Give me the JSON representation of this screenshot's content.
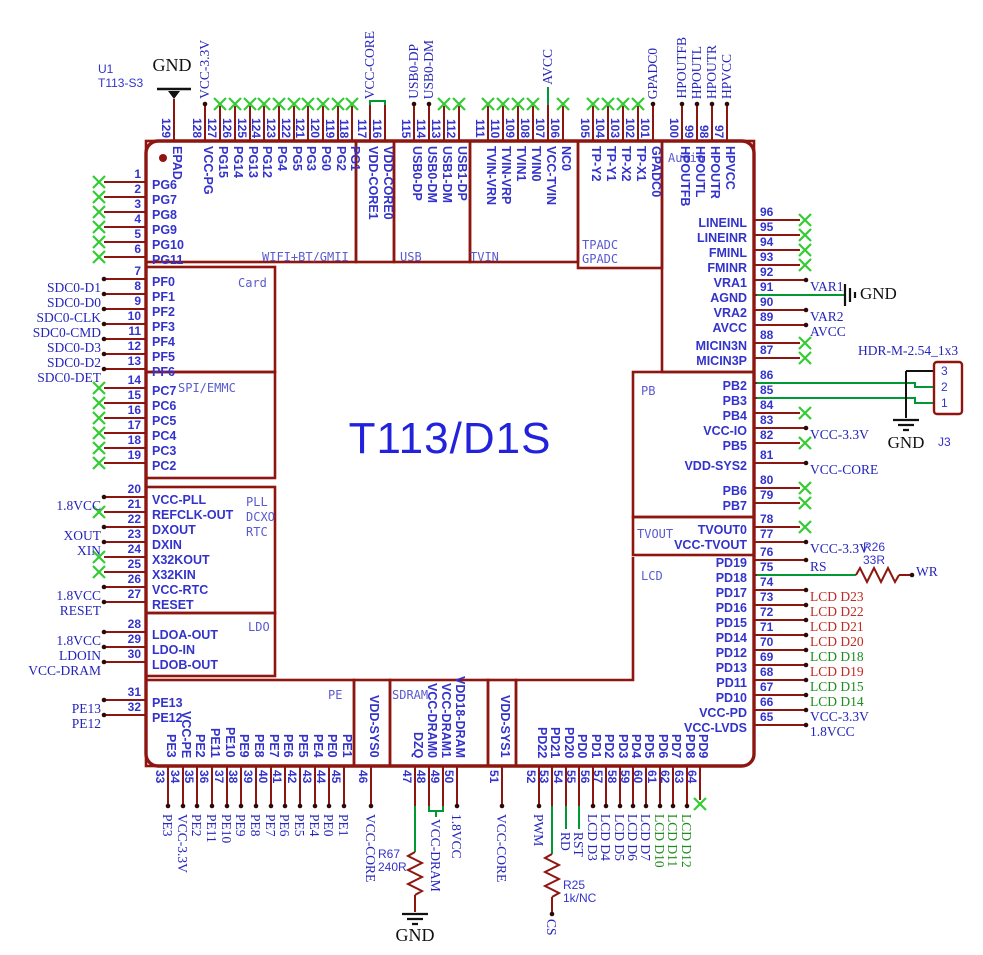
{
  "device": {
    "refdes": "U1",
    "part": "T113-S3",
    "title": "T113/D1S"
  },
  "labels": {
    "gnd": "GND"
  },
  "sections": [
    {
      "id": "wifi",
      "text": "WIFI+BT/GMII"
    },
    {
      "id": "usb",
      "text": "USB"
    },
    {
      "id": "tvin",
      "text": "TVIN"
    },
    {
      "id": "tpadc",
      "text": "TPADC"
    },
    {
      "id": "gpadc",
      "text": "GPADC"
    },
    {
      "id": "audio",
      "text": "Audio"
    },
    {
      "id": "card",
      "text": "Card"
    },
    {
      "id": "spi",
      "text": "SPI/EMMC"
    },
    {
      "id": "pll",
      "text": "PLL"
    },
    {
      "id": "dcxo",
      "text": "DCXO"
    },
    {
      "id": "rtc",
      "text": "RTC"
    },
    {
      "id": "ldo",
      "text": "LDO"
    },
    {
      "id": "pe",
      "text": "PE"
    },
    {
      "id": "sdram",
      "text": "SDRAM"
    },
    {
      "id": "pb",
      "text": "PB"
    },
    {
      "id": "tvout",
      "text": "TVOUT"
    },
    {
      "id": "lcd",
      "text": "LCD"
    }
  ],
  "components": {
    "r26": {
      "ref": "R26",
      "value": "33R",
      "net": "WR"
    },
    "r25": {
      "ref": "R25",
      "value": "1k/NC",
      "net": "CS"
    },
    "r67": {
      "ref": "R67",
      "value": "240R"
    },
    "j3": {
      "ref": "J3",
      "part": "HDR-M-2.54_1x3",
      "pins": [
        "3",
        "2",
        "1"
      ]
    }
  },
  "pins": {
    "top": [
      {
        "n": "129",
        "name": "EPAD",
        "mark": "long"
      },
      {
        "n": "128",
        "name": "VCC-PG",
        "mark": "dot",
        "net": {
          "t": "VCC-3.3V",
          "c": "blue"
        }
      },
      {
        "n": "127",
        "name": "PG15",
        "mark": "x"
      },
      {
        "n": "126",
        "name": "PG14",
        "mark": "x"
      },
      {
        "n": "125",
        "name": "PG13",
        "mark": "x"
      },
      {
        "n": "124",
        "name": "PG12",
        "mark": "x"
      },
      {
        "n": "123",
        "name": "PG4",
        "mark": "x"
      },
      {
        "n": "122",
        "name": "PG5",
        "mark": "x"
      },
      {
        "n": "121",
        "name": "PG3",
        "mark": "x"
      },
      {
        "n": "120",
        "name": "PG0",
        "mark": "x"
      },
      {
        "n": "119",
        "name": "PG2",
        "mark": "x"
      },
      {
        "n": "118",
        "name": "PG1",
        "mark": "x"
      },
      {
        "n": "117",
        "name": "VDD-CORE1",
        "mark": "none",
        "net": {
          "t": "VCC-CORE",
          "c": "blue"
        }
      },
      {
        "n": "116",
        "name": "VDD-CORE0",
        "mark": "none"
      },
      {
        "n": "115",
        "name": "USB0-DP",
        "mark": "dot",
        "net": {
          "t": "USB0-DP",
          "c": "blue"
        }
      },
      {
        "n": "114",
        "name": "USB0-DM",
        "mark": "dot",
        "net": {
          "t": "USB0-DM",
          "c": "blue"
        }
      },
      {
        "n": "113",
        "name": "USB1-DM",
        "mark": "x"
      },
      {
        "n": "112",
        "name": "USB1-DP",
        "mark": "x"
      },
      {
        "n": "111",
        "name": "TVIN-VRN",
        "mark": "x"
      },
      {
        "n": "110",
        "name": "TVIN-VRP",
        "mark": "x"
      },
      {
        "n": "109",
        "name": "TVIN1",
        "mark": "x"
      },
      {
        "n": "108",
        "name": "TVIN0",
        "mark": "x"
      },
      {
        "n": "107",
        "name": "VCC-TVIN",
        "mark": "none",
        "net": {
          "t": "AVCC",
          "c": "blue"
        },
        "lb": 870
      },
      {
        "n": "106",
        "name": "NC0",
        "mark": "x"
      },
      {
        "n": "105",
        "name": "TP-Y2",
        "mark": "x"
      },
      {
        "n": "104",
        "name": "TP-Y1",
        "mark": "x"
      },
      {
        "n": "103",
        "name": "TP-X2",
        "mark": "x"
      },
      {
        "n": "102",
        "name": "TP-X1",
        "mark": "x"
      },
      {
        "n": "101",
        "name": "GPADC0",
        "mark": "dot",
        "net": {
          "t": "GPADC0",
          "c": "blue"
        }
      },
      {
        "n": "100",
        "name": "HPOUTFB",
        "mark": "dot",
        "net": {
          "t": "HPOUTFB",
          "c": "blue"
        }
      },
      {
        "n": "99",
        "name": "HPOUTL",
        "mark": "dot",
        "net": {
          "t": "HPOUTL",
          "c": "blue"
        }
      },
      {
        "n": "98",
        "name": "HPOUTR",
        "mark": "dot",
        "net": {
          "t": "HPOUTR",
          "c": "blue"
        }
      },
      {
        "n": "97",
        "name": "HPVCC",
        "mark": "dot",
        "net": {
          "t": "HPVCC",
          "c": "blue"
        }
      }
    ],
    "left": [
      {
        "n": "1",
        "name": "PG6",
        "mark": "x"
      },
      {
        "n": "2",
        "name": "PG7",
        "mark": "x"
      },
      {
        "n": "3",
        "name": "PG8",
        "mark": "x"
      },
      {
        "n": "4",
        "name": "PG9",
        "mark": "x"
      },
      {
        "n": "5",
        "name": "PG10",
        "mark": "x"
      },
      {
        "n": "6",
        "name": "PG11",
        "mark": "x"
      },
      {
        "n": "7",
        "name": "PF0",
        "mark": "dot",
        "net": {
          "t": "SDC0-D1",
          "c": "blue"
        }
      },
      {
        "n": "8",
        "name": "PF1",
        "mark": "dot",
        "net": {
          "t": "SDC0-D0",
          "c": "blue"
        }
      },
      {
        "n": "9",
        "name": "PF2",
        "mark": "dot",
        "net": {
          "t": "SDC0-CLK",
          "c": "blue"
        }
      },
      {
        "n": "10",
        "name": "PF3",
        "mark": "dot",
        "net": {
          "t": "SDC0-CMD",
          "c": "blue"
        }
      },
      {
        "n": "11",
        "name": "PF4",
        "mark": "dot",
        "net": {
          "t": "SDC0-D3",
          "c": "blue"
        }
      },
      {
        "n": "12",
        "name": "PF5",
        "mark": "dot",
        "net": {
          "t": "SDC0-D2",
          "c": "blue"
        }
      },
      {
        "n": "13",
        "name": "PF6",
        "mark": "dot",
        "net": {
          "t": "SDC0-DET",
          "c": "blue"
        }
      },
      {
        "n": "14",
        "name": "PC7",
        "mark": "x"
      },
      {
        "n": "15",
        "name": "PC6",
        "mark": "x"
      },
      {
        "n": "16",
        "name": "PC5",
        "mark": "x"
      },
      {
        "n": "17",
        "name": "PC4",
        "mark": "x"
      },
      {
        "n": "18",
        "name": "PC3",
        "mark": "x"
      },
      {
        "n": "19",
        "name": "PC2",
        "mark": "x"
      },
      {
        "n": "20",
        "name": "VCC-PLL",
        "mark": "dot",
        "net": {
          "t": "1.8VCC",
          "c": "blue"
        }
      },
      {
        "n": "21",
        "name": "REFCLK-OUT",
        "mark": "x"
      },
      {
        "n": "22",
        "name": "DXOUT",
        "mark": "dot",
        "net": {
          "t": "XOUT",
          "c": "blue"
        }
      },
      {
        "n": "23",
        "name": "DXIN",
        "mark": "dot",
        "net": {
          "t": "XIN",
          "c": "blue"
        }
      },
      {
        "n": "24",
        "name": "X32KOUT",
        "mark": "x"
      },
      {
        "n": "25",
        "name": "X32KIN",
        "mark": "x"
      },
      {
        "n": "26",
        "name": "VCC-RTC",
        "mark": "dot",
        "net": {
          "t": "1.8VCC",
          "c": "blue"
        }
      },
      {
        "n": "27",
        "name": "RESET",
        "mark": "dot",
        "net": {
          "t": "RESET",
          "c": "blue"
        }
      },
      {
        "n": "28",
        "name": "LDOA-OUT",
        "mark": "dot",
        "net": {
          "t": "1.8VCC",
          "c": "blue"
        }
      },
      {
        "n": "29",
        "name": "LDO-IN",
        "mark": "dot",
        "net": {
          "t": "LDOIN",
          "c": "blue"
        }
      },
      {
        "n": "30",
        "name": "LDOB-OUT",
        "mark": "dot",
        "net": {
          "t": "VCC-DRAM",
          "c": "blue"
        }
      },
      {
        "n": "31",
        "name": "PE13",
        "mark": "dot",
        "net": {
          "t": "PE13",
          "c": "blue"
        }
      },
      {
        "n": "32",
        "name": "PE12",
        "mark": "dot",
        "net": {
          "t": "PE12",
          "c": "blue"
        }
      }
    ],
    "right": [
      {
        "n": "96",
        "name": "LINEINL",
        "mark": "x"
      },
      {
        "n": "95",
        "name": "LINEINR",
        "mark": "x"
      },
      {
        "n": "94",
        "name": "FMINL",
        "mark": "x"
      },
      {
        "n": "93",
        "name": "FMINR",
        "mark": "x"
      },
      {
        "n": "92",
        "name": "VRA1",
        "mark": "dot",
        "net": {
          "t": "VAR1",
          "c": "blue"
        }
      },
      {
        "n": "91",
        "name": "AGND",
        "mark": "none"
      },
      {
        "n": "90",
        "name": "VRA2",
        "mark": "dot",
        "net": {
          "t": "VAR2",
          "c": "blue"
        }
      },
      {
        "n": "89",
        "name": "AVCC",
        "mark": "dot",
        "net": {
          "t": "AVCC",
          "c": "blue"
        }
      },
      {
        "n": "88",
        "name": "MICIN3N",
        "mark": "x"
      },
      {
        "n": "87",
        "name": "MICIN3P",
        "mark": "x"
      },
      {
        "n": "86",
        "name": "PB2",
        "mark": "none"
      },
      {
        "n": "85",
        "name": "PB3",
        "mark": "none"
      },
      {
        "n": "84",
        "name": "PB4",
        "mark": "x"
      },
      {
        "n": "83",
        "name": "VCC-IO",
        "mark": "dot",
        "net": {
          "t": "VCC-3.3V",
          "c": "blue"
        }
      },
      {
        "n": "82",
        "name": "PB5",
        "mark": "x"
      },
      {
        "n": "81",
        "name": "VDD-SYS2",
        "mark": "dot",
        "net": {
          "t": "VCC-CORE",
          "c": "blue"
        }
      },
      {
        "n": "80",
        "name": "PB6",
        "mark": "x"
      },
      {
        "n": "79",
        "name": "PB7",
        "mark": "x"
      },
      {
        "n": "78",
        "name": "TVOUT0",
        "mark": "x"
      },
      {
        "n": "77",
        "name": "VCC-TVOUT",
        "mark": "dot",
        "net": {
          "t": "VCC-3.3V",
          "c": "blue"
        }
      },
      {
        "n": "76",
        "name": "PD19",
        "mark": "dot",
        "net": {
          "t": "RS",
          "c": "blue"
        }
      },
      {
        "n": "75",
        "name": "PD18",
        "mark": "none"
      },
      {
        "n": "74",
        "name": "PD17",
        "mark": "dot",
        "net": {
          "t": "LCD D23",
          "c": "red"
        }
      },
      {
        "n": "73",
        "name": "PD16",
        "mark": "dot",
        "net": {
          "t": "LCD D22",
          "c": "red"
        }
      },
      {
        "n": "72",
        "name": "PD15",
        "mark": "dot",
        "net": {
          "t": "LCD D21",
          "c": "red"
        }
      },
      {
        "n": "71",
        "name": "PD14",
        "mark": "dot",
        "net": {
          "t": "LCD D20",
          "c": "red"
        }
      },
      {
        "n": "70",
        "name": "PD12",
        "mark": "dot",
        "net": {
          "t": "LCD D18",
          "c": "green"
        }
      },
      {
        "n": "69",
        "name": "PD13",
        "mark": "dot",
        "net": {
          "t": "LCD D19",
          "c": "red"
        }
      },
      {
        "n": "68",
        "name": "PD11",
        "mark": "dot",
        "net": {
          "t": "LCD D15",
          "c": "green"
        }
      },
      {
        "n": "67",
        "name": "PD10",
        "mark": "dot",
        "net": {
          "t": "LCD D14",
          "c": "green"
        }
      },
      {
        "n": "66",
        "name": "VCC-PD",
        "mark": "dot",
        "net": {
          "t": "VCC-3.3V",
          "c": "blue"
        }
      },
      {
        "n": "65",
        "name": "VCC-LVDS",
        "mark": "dot",
        "net": {
          "t": "1.8VCC",
          "c": "blue"
        }
      }
    ],
    "bottom": [
      {
        "n": "33",
        "name": "PE3",
        "mark": "dot",
        "net": {
          "t": "PE3",
          "c": "blue"
        }
      },
      {
        "n": "34",
        "name": "VCC-PE",
        "mark": "dot",
        "net": {
          "t": "VCC-3.3V",
          "c": "blue"
        }
      },
      {
        "n": "35",
        "name": "PE2",
        "mark": "dot",
        "net": {
          "t": "PE2",
          "c": "blue"
        }
      },
      {
        "n": "36",
        "name": "PE11",
        "mark": "dot",
        "net": {
          "t": "PE11",
          "c": "blue"
        }
      },
      {
        "n": "37",
        "name": "PE10",
        "mark": "dot",
        "net": {
          "t": "PE10",
          "c": "blue"
        }
      },
      {
        "n": "38",
        "name": "PE9",
        "mark": "dot",
        "net": {
          "t": "PE9",
          "c": "blue"
        }
      },
      {
        "n": "39",
        "name": "PE8",
        "mark": "dot",
        "net": {
          "t": "PE8",
          "c": "blue"
        }
      },
      {
        "n": "40",
        "name": "PE7",
        "mark": "dot",
        "net": {
          "t": "PE7",
          "c": "blue"
        }
      },
      {
        "n": "41",
        "name": "PE6",
        "mark": "dot",
        "net": {
          "t": "PE6",
          "c": "blue"
        }
      },
      {
        "n": "42",
        "name": "PE5",
        "mark": "dot",
        "net": {
          "t": "PE5",
          "c": "blue"
        }
      },
      {
        "n": "43",
        "name": "PE4",
        "mark": "dot",
        "net": {
          "t": "PE4",
          "c": "blue"
        }
      },
      {
        "n": "44",
        "name": "PE0",
        "mark": "dot",
        "net": {
          "t": "PE0",
          "c": "blue"
        }
      },
      {
        "n": "45",
        "name": "PE1",
        "mark": "dot",
        "net": {
          "t": "PE1",
          "c": "blue"
        }
      },
      {
        "n": "46",
        "name": "VDD-SYS0",
        "mark": "dot",
        "net": {
          "t": "VCC-CORE",
          "c": "blue"
        }
      },
      {
        "n": "47",
        "name": "DZQ",
        "mark": "none"
      },
      {
        "n": "48",
        "name": "VCC-DRAM0",
        "mark": "none"
      },
      {
        "n": "49",
        "name": "VCC-DRAM1",
        "mark": "none"
      },
      {
        "n": "50",
        "name": "VDD18-DRAM",
        "mark": "dot",
        "net": {
          "t": "1.8VCC",
          "c": "blue"
        }
      },
      {
        "n": "51",
        "name": "VDD-SYS1",
        "mark": "dot",
        "net": {
          "t": "VCC-CORE",
          "c": "blue"
        }
      },
      {
        "n": "52",
        "name": "PD22",
        "mark": "dot",
        "net": {
          "t": "PWM",
          "c": "blue"
        }
      },
      {
        "n": "53",
        "name": "PD21",
        "mark": "none"
      },
      {
        "n": "54",
        "name": "PD20",
        "mark": "none",
        "net": {
          "t": "RD",
          "c": "blue"
        },
        "lt": 832
      },
      {
        "n": "55",
        "name": "PD0",
        "mark": "none",
        "net": {
          "t": "RST",
          "c": "blue"
        },
        "lt": 832
      },
      {
        "n": "56",
        "name": "PD1",
        "mark": "dot",
        "net": {
          "t": "LCD D3",
          "c": "blue"
        }
      },
      {
        "n": "57",
        "name": "PD2",
        "mark": "dot",
        "net": {
          "t": "LCD D4",
          "c": "blue"
        }
      },
      {
        "n": "58",
        "name": "PD3",
        "mark": "dot",
        "net": {
          "t": "LCD D5",
          "c": "blue"
        }
      },
      {
        "n": "59",
        "name": "PD4",
        "mark": "dot",
        "net": {
          "t": "LCD D6",
          "c": "blue"
        }
      },
      {
        "n": "60",
        "name": "PD5",
        "mark": "dot",
        "net": {
          "t": "LCD D7",
          "c": "blue"
        }
      },
      {
        "n": "61",
        "name": "PD6",
        "mark": "dot",
        "net": {
          "t": "LCD D10",
          "c": "green"
        }
      },
      {
        "n": "62",
        "name": "PD7",
        "mark": "dot",
        "net": {
          "t": "LCD D11",
          "c": "green"
        }
      },
      {
        "n": "63",
        "name": "PD8",
        "mark": "dot",
        "net": {
          "t": "LCD D12",
          "c": "green"
        }
      },
      {
        "n": "64",
        "name": "PD9",
        "mark": "x"
      }
    ]
  },
  "extra_nets": {
    "vcc_dram": "VCC-DRAM"
  },
  "colors": {
    "wire": "#8e1610",
    "pin_text": "#3333cc",
    "net_blue": "#2424bb",
    "net_red": "#c02a22",
    "net_green": "#1f8c1f",
    "nc_x": "#33cc33",
    "green_wire": "#009933",
    "title": "#2222dd",
    "section": "#5a5ad0",
    "black": "#111111"
  }
}
